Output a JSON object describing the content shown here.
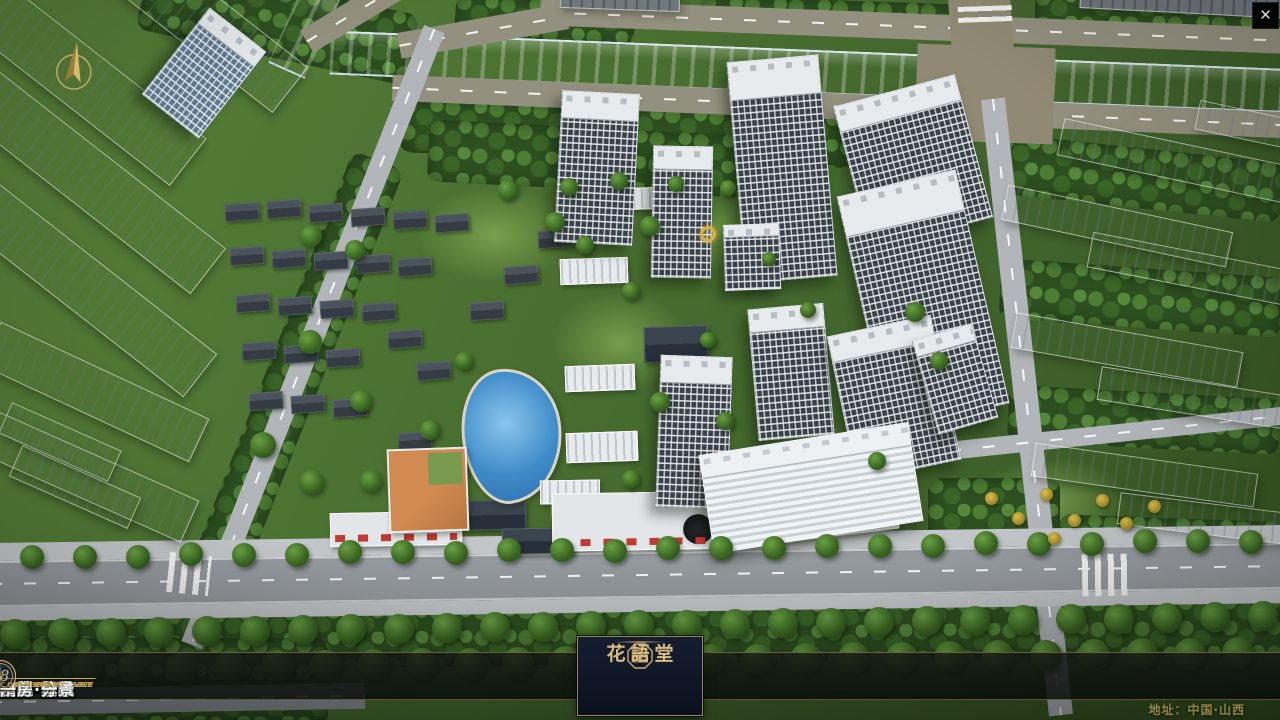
{
  "window": {
    "close_icon": "✕"
  },
  "navbar": {
    "items": [
      {
        "num": "o1",
        "title": "品牌·介绍",
        "subtitle": "BRAND SUPPORT"
      },
      {
        "num": "o2",
        "title": "区位·价值",
        "subtitle": "LOCATION VALUE"
      },
      {
        "num": "o3",
        "title": "项目·概况",
        "subtitle": "PROJECT SURVEY"
      },
      {
        "num": "o4",
        "title": "建筑·鉴赏",
        "subtitle": "APPRECIATION"
      },
      {
        "num": "o5",
        "title": "园林·景观",
        "subtitle": "GARDEN STREET"
      },
      {
        "num": "o6",
        "title": "精装·体验",
        "subtitle": "EXPERIENCE"
      },
      {
        "num": "o7",
        "title": "户型·分布",
        "subtitle": "SHOW ROOM"
      },
      {
        "num": "o8",
        "title": "一房·一景",
        "subtitle": "COMMUNITY"
      }
    ]
  },
  "logo": {
    "title": "花語堂"
  },
  "footer": {
    "address": "地址：中国·山西"
  },
  "colors": {
    "accent_gold": "#c9a96a",
    "panel_navy": "#10182a",
    "river_blue": "#2157c9"
  }
}
